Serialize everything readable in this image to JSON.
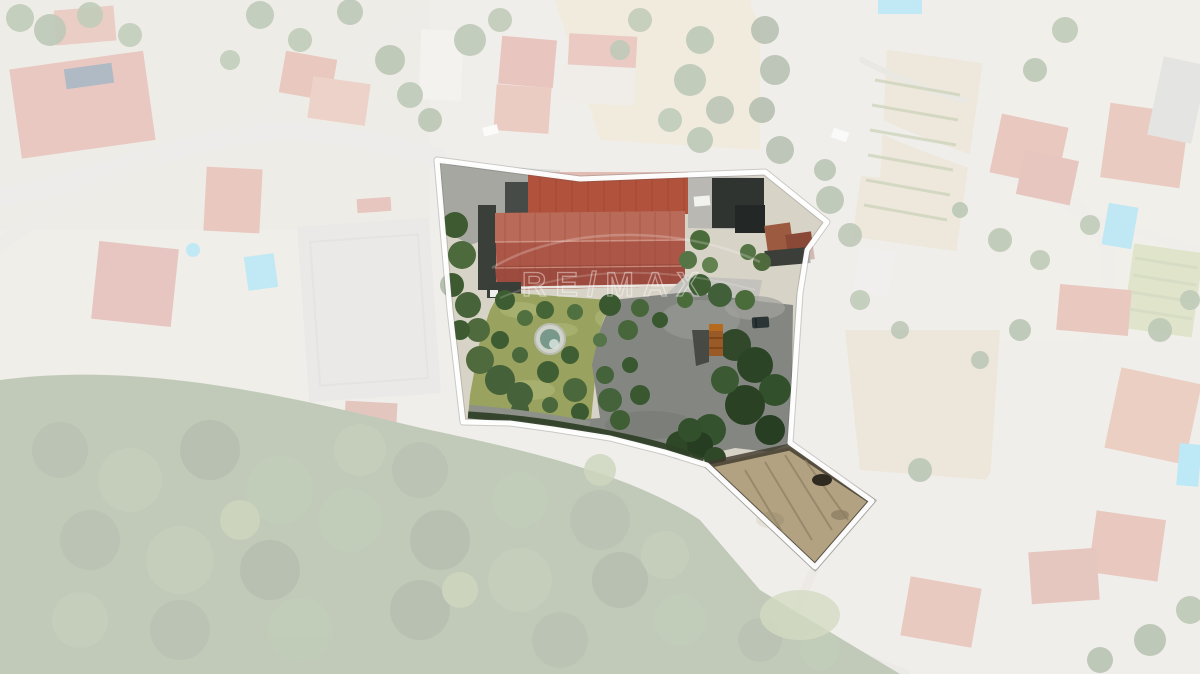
{
  "page": {
    "description": "Aerial drone photograph of a property for sale with highlighted parcel boundary; surroundings are faded white",
    "width_px": 1200,
    "height_px": 674
  },
  "watermark": {
    "text": "RE/MAX",
    "color": "#ffffff",
    "opacity": 0.42
  },
  "boundary": {
    "stroke_color": "#ffffff",
    "stroke_width": 5,
    "fade_color": "#ffffff",
    "fade_opacity": 0.62,
    "points": "437,160 580,179 765,172 827,222 807,250 800,293 790,443 872,501 815,567 707,465 665,452 610,438 553,429 510,423 463,422 450,310",
    "fade_path": "M0,0 H1200 V674 H0 Z M437,160 L580,179 L765,172 L827,222 L807,250 L800,293 L790,443 L872,501 L815,567 L707,465 L665,452 L610,438 L553,429 L510,423 L463,422 L450,310 Z"
  },
  "scene": {
    "type": "aerial-photo",
    "inside_parcel_features": [
      "large red gable warehouse roof",
      "secondary red corrugated roof",
      "dark outbuildings and white van",
      "olive lawn garden with trees and round pond",
      "gray asphalt yard with rusty truck trailer and dark car",
      "lower terraced dirt plot (south-east tail)"
    ],
    "palette": {
      "roof_red": "#ac5647",
      "lawn_olive": "#99a35f",
      "asphalt_gray": "#848682",
      "forest_green": "#4a6238",
      "dirt_tan": "#b3a282",
      "pool_blue": "#5bc4e4",
      "road_gray": "#d0cdc7"
    }
  }
}
